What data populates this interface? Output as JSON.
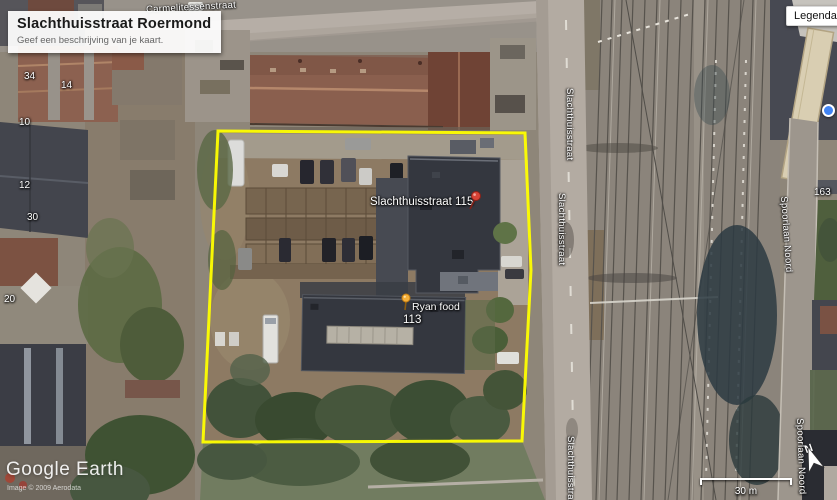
{
  "title_card": {
    "title": "Slachthuisstraat Roermond",
    "subtitle": "Geef een beschrijving van je kaart."
  },
  "legend": {
    "label": "Legenda"
  },
  "placemarks": {
    "p115": {
      "label": "Slachthuisstraat 115",
      "icon": "red-pushpin"
    },
    "ryan": {
      "label": "Ryan food",
      "icon": "yellow-pushpin"
    },
    "p113": {
      "label": "113"
    }
  },
  "streets": {
    "top": "Carmelitessenstraat",
    "main": "Slachthuisstraat",
    "right": "Spoorlaan Noord"
  },
  "house_numbers": {
    "a": "34",
    "b": "14",
    "c": "10",
    "d": "12",
    "e": "30",
    "f": "20",
    "g": "163"
  },
  "compass": {
    "north": "N"
  },
  "scale": {
    "label": "30 m"
  },
  "attribution": {
    "brand": "Google Earth",
    "credit": "Image © 2009 Aerodata"
  },
  "colors": {
    "parcel_outline": "#ffff00",
    "pushpin_red": "#d84336",
    "pushpin_yellow": "#f5b03a",
    "marker_blue": "#4285f4"
  }
}
